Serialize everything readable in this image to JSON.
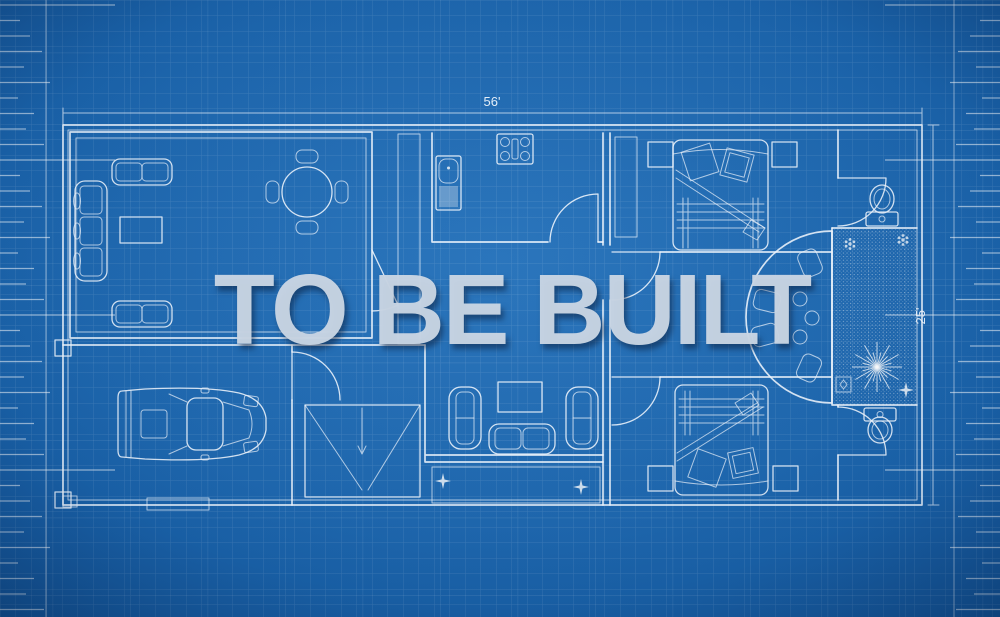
{
  "overlay": {
    "text": "TO BE BUILT"
  },
  "dimension_labels": {
    "top": "56'",
    "right": "25'"
  },
  "colors": {
    "background": "#1c66ae",
    "background_edge": "#13569a",
    "grid_line": "rgba(255,255,255,0.13)",
    "plan_line": "#f2f8ff",
    "overlay_text": "#c8d5e3"
  },
  "icons": [
    "sofa-icon",
    "loveseat-icon",
    "coffee-table-icon",
    "dining-table-icon",
    "chair-icon",
    "stove-icon",
    "refrigerator-icon",
    "bed-icon",
    "pillow-icon",
    "nightstand-icon",
    "toilet-icon",
    "armchair-icon",
    "tv-console-icon",
    "stairs-icon",
    "car-icon",
    "plant-starburst-icon",
    "flower-icon",
    "sparkle-icon",
    "ruler-ticks"
  ]
}
